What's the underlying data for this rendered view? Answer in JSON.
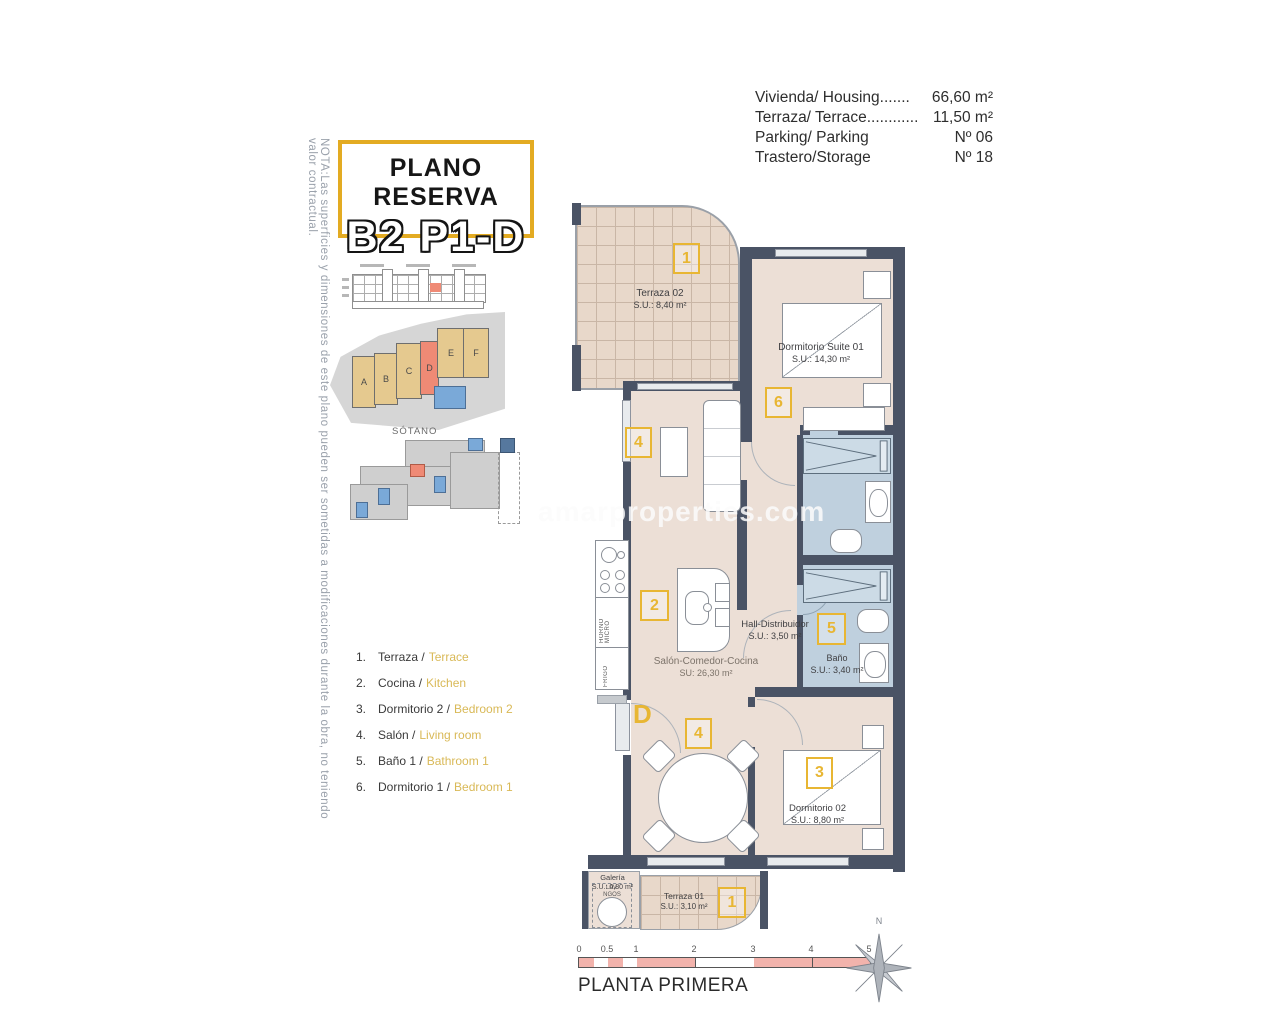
{
  "palette": {
    "accent_yellow": "#e8b633",
    "wall": "#4a5365",
    "floor": "#ecdfd6",
    "bathroom_blue": "#bfd0de",
    "terrace_tile": "#e8d8ca",
    "highlight_red": "#ef8a75",
    "pool_blue": "#7aa9d8",
    "scale_pink": "#f2b3ac",
    "legend_en_yellow": "#d9b957"
  },
  "note": "NOTA:Las superficies y dimensiones de este plano pueden ser sometidas a modificaciones durante la obra, no teniendo valor contractual.",
  "title": {
    "line1": "PLANO RESERVA",
    "line2": "B2 P1-D"
  },
  "specs": {
    "rows": [
      {
        "label": "Vivienda/ Housing.......",
        "value": "66,60 m²"
      },
      {
        "label": "Terraza/ Terrace............",
        "value": "11,50 m²"
      },
      {
        "label": "Parking/ Parking",
        "value": "Nº 06"
      },
      {
        "label": "Trastero/Storage",
        "value": "Nº 18"
      }
    ]
  },
  "site": {
    "buildings": [
      "A",
      "B",
      "C",
      "D",
      "E",
      "F"
    ],
    "sotano_label": "SÓTANO"
  },
  "legend": {
    "items": [
      {
        "num": "1.",
        "es": "Terraza /",
        "en": "Terrace"
      },
      {
        "num": "2.",
        "es": "Cocina /",
        "en": "Kitchen"
      },
      {
        "num": "3.",
        "es": "Dormitorio 2 /",
        "en": "Bedroom 2"
      },
      {
        "num": "4.",
        "es": "Salón /",
        "en": "Living room"
      },
      {
        "num": "5.",
        "es": "Baño 1 /",
        "en": "Bathroom 1"
      },
      {
        "num": "6.",
        "es": "Dormitorio 1 /",
        "en": "Bedroom 1"
      }
    ]
  },
  "plan": {
    "watermark": "amarproperties.com",
    "door_label": "D",
    "kitchen": {
      "oven": "HORNO MICRO",
      "fridge": "FRIGO"
    },
    "rooms": {
      "terraza02": {
        "name": "Terraza 02",
        "area": "S.U.: 8,40 m²",
        "tag": "1"
      },
      "suite": {
        "name": "Dormitorio Suite 01",
        "area": "S.U.: 14,30 m²",
        "tag": "6"
      },
      "salon": {
        "name": "Salón-Comedor-Cocina",
        "area": "SU: 26,30 m²",
        "tag_sofa": "4",
        "tag_dining": "4",
        "tag_kitchen": "2"
      },
      "hall": {
        "name": "Hall-Distribuidor",
        "area": "S.U.: 3,50 m²"
      },
      "bano": {
        "name": "Baño",
        "area": "S.U.: 3,40 m²",
        "tag": "5"
      },
      "dorm02": {
        "name": "Dormitorio 02",
        "area": "S.U.: 8,80 m²",
        "tag": "3"
      },
      "galeria": {
        "name": "Galería",
        "area": "S.U.: 0,80 m²",
        "appliance_line1": "LAV.",
        "appliance_line2": "NGOS"
      },
      "terraza01": {
        "name": "Terraza 01",
        "area": "S.U.: 3,10 m²",
        "tag": "1"
      }
    }
  },
  "scale": {
    "ticks": [
      "0",
      "0.5",
      "1",
      "2",
      "3",
      "4",
      "5"
    ]
  },
  "footer": {
    "caption": "PLANTA PRIMERA"
  },
  "compass": {
    "label": "N"
  }
}
